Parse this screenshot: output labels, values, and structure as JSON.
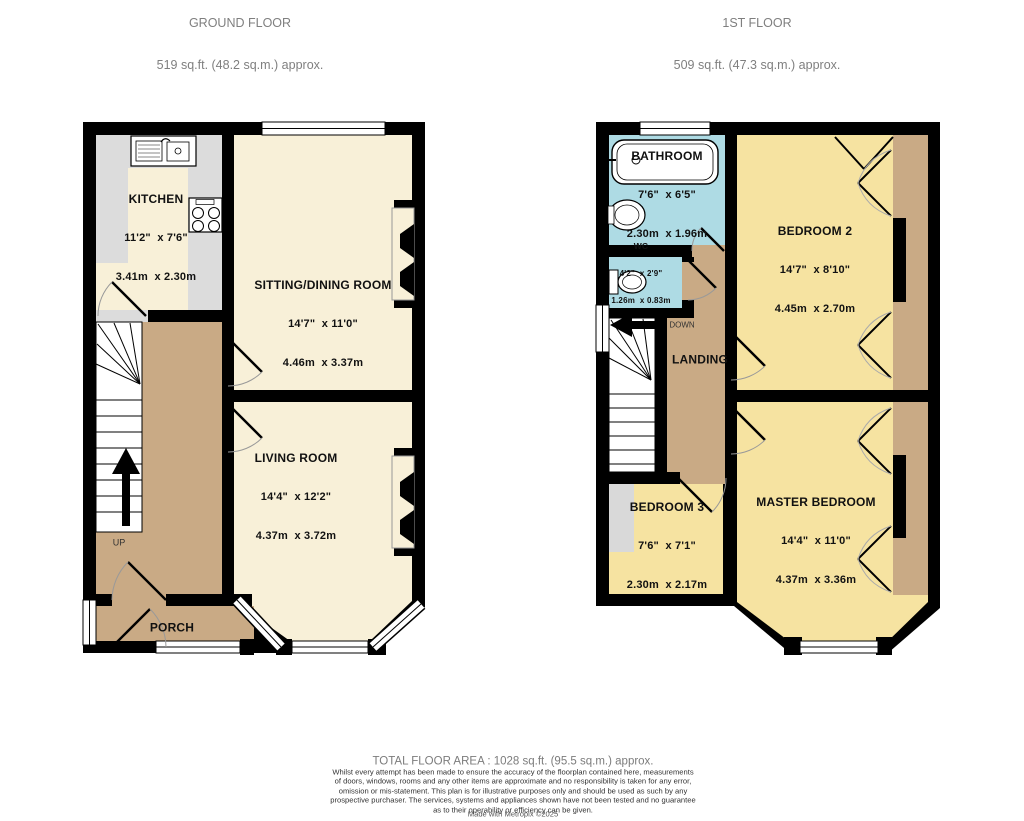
{
  "ground_floor": {
    "title": "GROUND FLOOR",
    "subtitle": "519 sq.ft. (48.2 sq.m.) approx.",
    "stairs_label": "UP",
    "rooms": {
      "kitchen": {
        "name": "KITCHEN",
        "imperial": "11'2\"  x 7'6\"",
        "metric": "3.41m  x 2.30m"
      },
      "sitting_dining": {
        "name": "SITTING/DINING ROOM",
        "imperial": "14'7\"  x 11'0\"",
        "metric": "4.46m  x 3.37m"
      },
      "living": {
        "name": "LIVING ROOM",
        "imperial": "14'4\"  x 12'2\"",
        "metric": "4.37m  x 3.72m"
      },
      "porch": {
        "name": "PORCH"
      }
    }
  },
  "first_floor": {
    "title": "1ST FLOOR",
    "subtitle": "509 sq.ft. (47.3 sq.m.) approx.",
    "stairs_label": "DOWN",
    "rooms": {
      "bathroom": {
        "name": "BATHROOM",
        "imperial": "7'6\"  x 6'5\"",
        "metric": "2.30m  x 1.96m"
      },
      "wc": {
        "name": "WC",
        "imperial": "4'2\"  x 2'9\"",
        "metric": "1.26m  x 0.83m"
      },
      "bedroom2": {
        "name": "BEDROOM 2",
        "imperial": "14'7\"  x 8'10\"",
        "metric": "4.45m  x 2.70m"
      },
      "landing": {
        "name": "LANDING"
      },
      "bedroom3": {
        "name": "BEDROOM 3",
        "imperial": "7'6\"  x 7'1\"",
        "metric": "2.30m  x 2.17m"
      },
      "master": {
        "name": "MASTER BEDROOM",
        "imperial": "14'4\"  x 11'0\"",
        "metric": "4.37m  x 3.36m"
      }
    }
  },
  "footer": {
    "total": "TOTAL FLOOR AREA : 1028 sq.ft. (95.5 sq.m.) approx.",
    "disclaimer_lines": [
      "Whilst every attempt has been made to ensure the accuracy of the floorplan contained here, measurements",
      "of doors, windows, rooms and any other items are approximate and no responsibility is taken for any error,",
      "omission or mis-statement. This plan is for illustrative purposes only and should be used as such by any",
      "prospective purchaser. The services, systems and appliances shown have not been tested and no guarantee",
      "as to their operability or efficiency can be given."
    ],
    "credit": "Made with Metropix ©2025"
  },
  "colors": {
    "wall": "#000000",
    "room_cream": "#f8f0d8",
    "bedroom_yellow": "#f6e3a1",
    "hall_tan": "#c9aa85",
    "bath_blue": "#aedbe4",
    "counter_gray": "#dcdcdc",
    "title_gray": "#7f7f7f"
  }
}
